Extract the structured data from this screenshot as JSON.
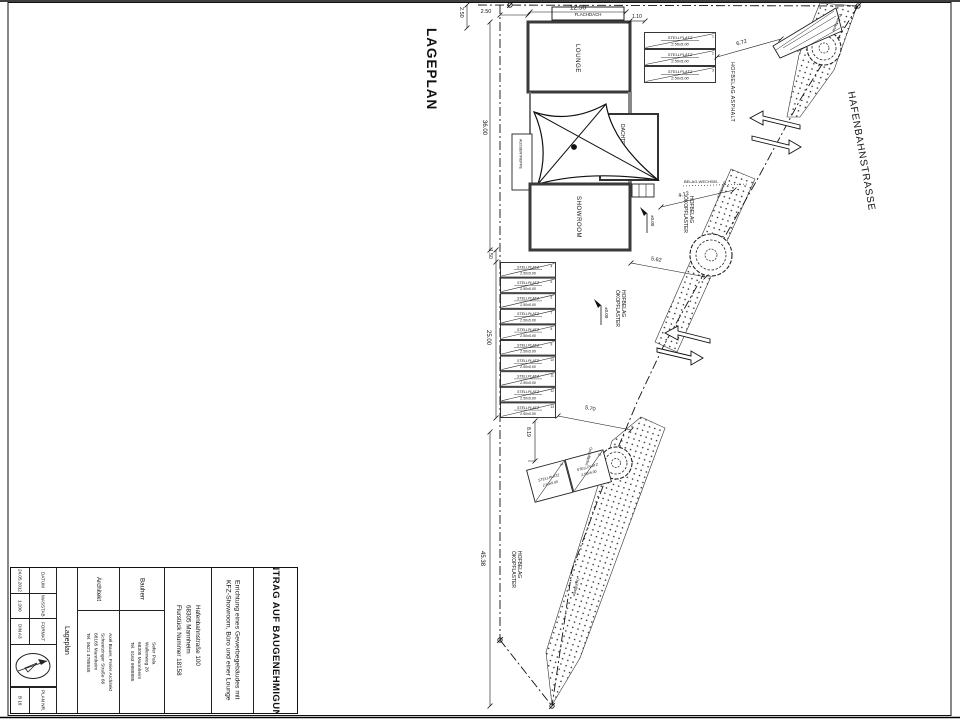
{
  "plan": {
    "title": "LAGEPLAN",
    "street": "HAFENBAHNSTRASSE",
    "buildings": {
      "flachdach": "FLACHDACH",
      "lounge": "LOUNGE",
      "dachterrasse": "DACHTERRASSE",
      "aussentreppe": "AUSSENTREPPE",
      "showroom": "SHOWROOM"
    },
    "surfaces": {
      "asphalt": "HOFBELAG ASPHALT",
      "oeko_line1": "HOFBELAG",
      "oeko_line2": "ÖKOPFLASTER",
      "belagwechsel": "BELAG-WECHSEL",
      "gruenflaeche": "Grünfläche"
    },
    "level_marker": "±0.00",
    "stall": {
      "line1": "STELLPLATZ",
      "line2": "2.50x5.00"
    },
    "stall_numbers": [
      "1",
      "2",
      "3",
      "4",
      "5",
      "6",
      "7",
      "8",
      "9",
      "10",
      "11",
      "12",
      "13",
      "14",
      "15"
    ],
    "dimensions": {
      "d1250": "12.50",
      "d250": "2.50",
      "d110": "1.10",
      "d672": "6.72",
      "d3600": "36.00",
      "d150": "1.50",
      "d2500": "25.00",
      "d412": "4.12",
      "d562": "5.62",
      "d570": "5.70",
      "d819": "8.19",
      "d4538": "45.38"
    }
  },
  "title_block": {
    "application_title": "ANTRAG AUF BAUGENEHMIGUNG",
    "project_line1": "Errichtung eines Gewerbegebäudes mit",
    "project_line2": "KFZ-Showroom, Büro und einer Lounge",
    "address_line1": "Hafenbahnstraße 100",
    "address_line2": "68305 Mannheim",
    "address_line3": "Flurstück Nummer 18158",
    "client_label": "Bauherr",
    "client_line1": "Sefer Pala",
    "client_line2": "Wallenweg 26",
    "client_line3": "68305 Mannheim",
    "client_line4": "Tel. 0163 9888885",
    "architect_label": "Architekt",
    "architect_line1": "Axel Bauer, Freier Architekt",
    "architect_line2": "Schwetzinger Straße 66",
    "architect_line3": "68165 Mannheim",
    "architect_line4": "Tel. 0621 4785545",
    "plan_name": "Lageplan",
    "datum_label": "DATUM",
    "datum_value": "24.05.2012",
    "massstab_label": "MASSTAB",
    "massstab_value": "1:200",
    "format_label": "FORMAT",
    "format_value": "DIN A3",
    "plan_nr_label": "PLAN NR.",
    "plan_nr_value": "B 18"
  }
}
